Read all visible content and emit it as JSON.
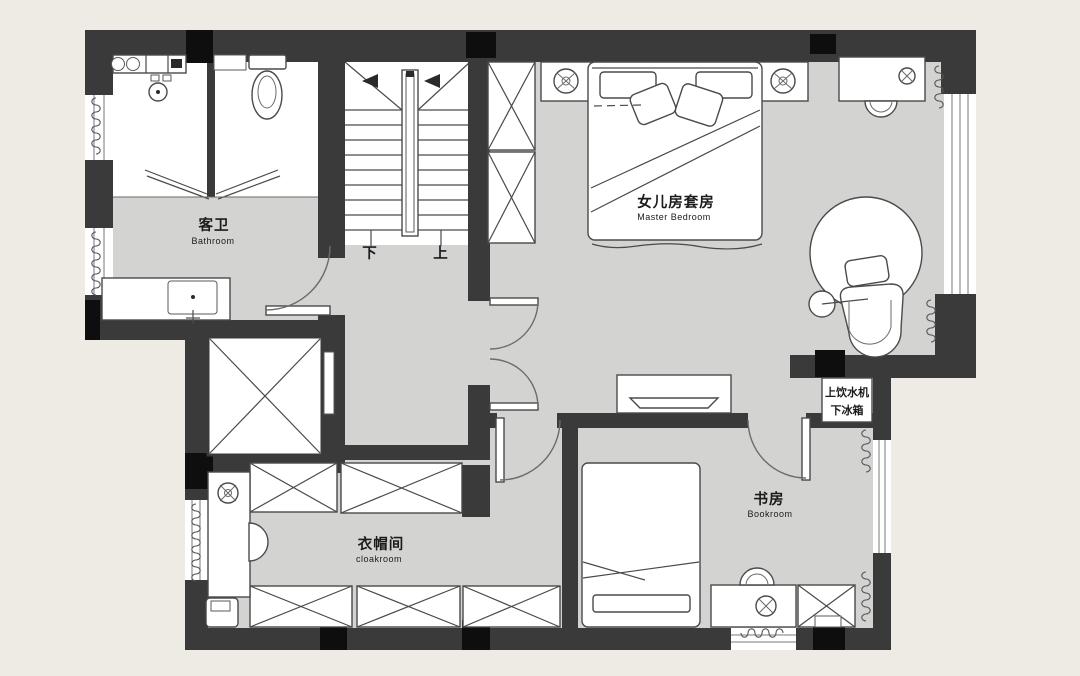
{
  "plan": {
    "title": "second-floor-plan",
    "colors": {
      "background": "#eeebe5",
      "floor": "#d3d3d2",
      "wall": "#3a3a3a",
      "pillar": "#0e0e0e",
      "fixture": "#ffffff",
      "text": "#1b1b1b"
    },
    "rooms": {
      "bathroom": {
        "zh": "客卫",
        "en": "Bathroom"
      },
      "master": {
        "zh": "女儿房套房",
        "en": "Master Bedroom"
      },
      "bookroom": {
        "zh": "书房",
        "en": "Bookroom"
      },
      "cloakroom": {
        "zh": "衣帽间",
        "en": "cloakroom"
      }
    },
    "stairs": {
      "down": "下",
      "up": "上"
    },
    "notes": {
      "water_dispenser": "上饮水机",
      "fridge": "下冰箱"
    },
    "icons": [
      "basin-icon",
      "shower-head-icon",
      "toilet-icon",
      "sink-icon",
      "faucet-icon",
      "table-lamp-icon",
      "ceiling-lamp-icon",
      "mirror-icon",
      "bed-icon",
      "pillow-icon",
      "desk-icon",
      "chair-icon",
      "wardrobe-x-icon",
      "elevator-x-icon",
      "rug-icon",
      "lounge-chair-icon",
      "side-table-icon",
      "tv-icon",
      "door-swing-icon",
      "window-icon",
      "curtain-coil-icon",
      "stair-arrow-icon",
      "laundry-basket-icon"
    ]
  }
}
